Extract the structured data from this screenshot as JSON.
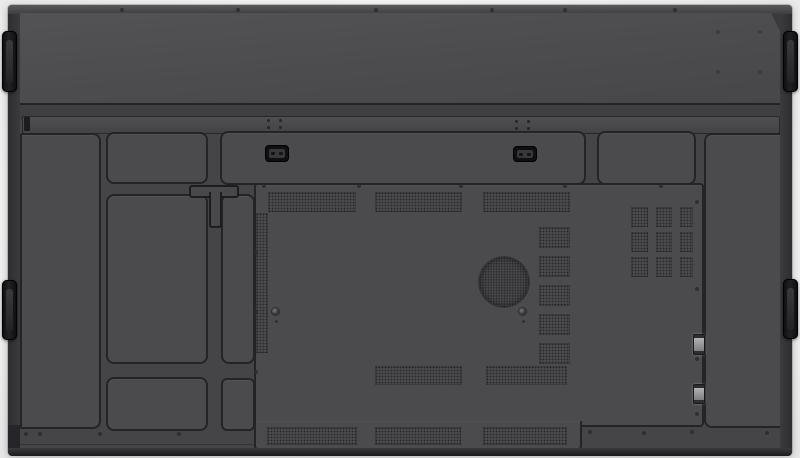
{
  "image": {
    "type": "product-photo",
    "subject": "Rear view of a large wall-mountable flat panel display",
    "width_px": 800,
    "height_px": 458,
    "contains_text": false
  },
  "theme": {
    "bg": "#f5f5f5",
    "body": "#3a3a3c",
    "face": "#454548",
    "panel": "#4b4b4d",
    "outline": "#242427",
    "ventdot": "#27272a",
    "handle_black": "#141417",
    "hinge_metal": "#a2a2a4",
    "edge_dark": "#1b1b1e"
  },
  "labels": {
    "device": "Rear of flat panel display",
    "top_cover": "Upper rear cover",
    "rail": "Horizontal mounting rail",
    "left_column": "Left rear panel section",
    "right_column": "Right rear panel section",
    "mid_top_panel": "Upper middle access panel",
    "wide_bar": "Top connector bar panel",
    "top_right_panel": "Upper right access panel",
    "mid_left_panel": "Middle left access panel",
    "narrow_panel": "Narrow vertical access panel",
    "low_mid_panel": "Lower middle access panel",
    "low_narrow_panel": "Lower narrow access panel",
    "central_panel": "Central electronics cover",
    "t_slot": "T-shaped routing slot",
    "connector_cutout_1": "Connector cutout left",
    "connector_cutout_2": "Connector cutout right",
    "speaker": "Round speaker grille",
    "vent": "Ventilation grille",
    "hinge": "Metal clip on module seam",
    "handle": "Recessed side handle",
    "screw": "Screw"
  },
  "counts": {
    "handles": 4,
    "speaker_grilles": 1,
    "top_vent_strips": 3,
    "mid_vent_strips": 2,
    "bottom_vent_strips": 3,
    "stacked_vent_squares": 5,
    "vent_grid_rows": 3,
    "vent_grid_cols": 3,
    "connector_cutouts": 2,
    "seam_hinges": 2
  }
}
